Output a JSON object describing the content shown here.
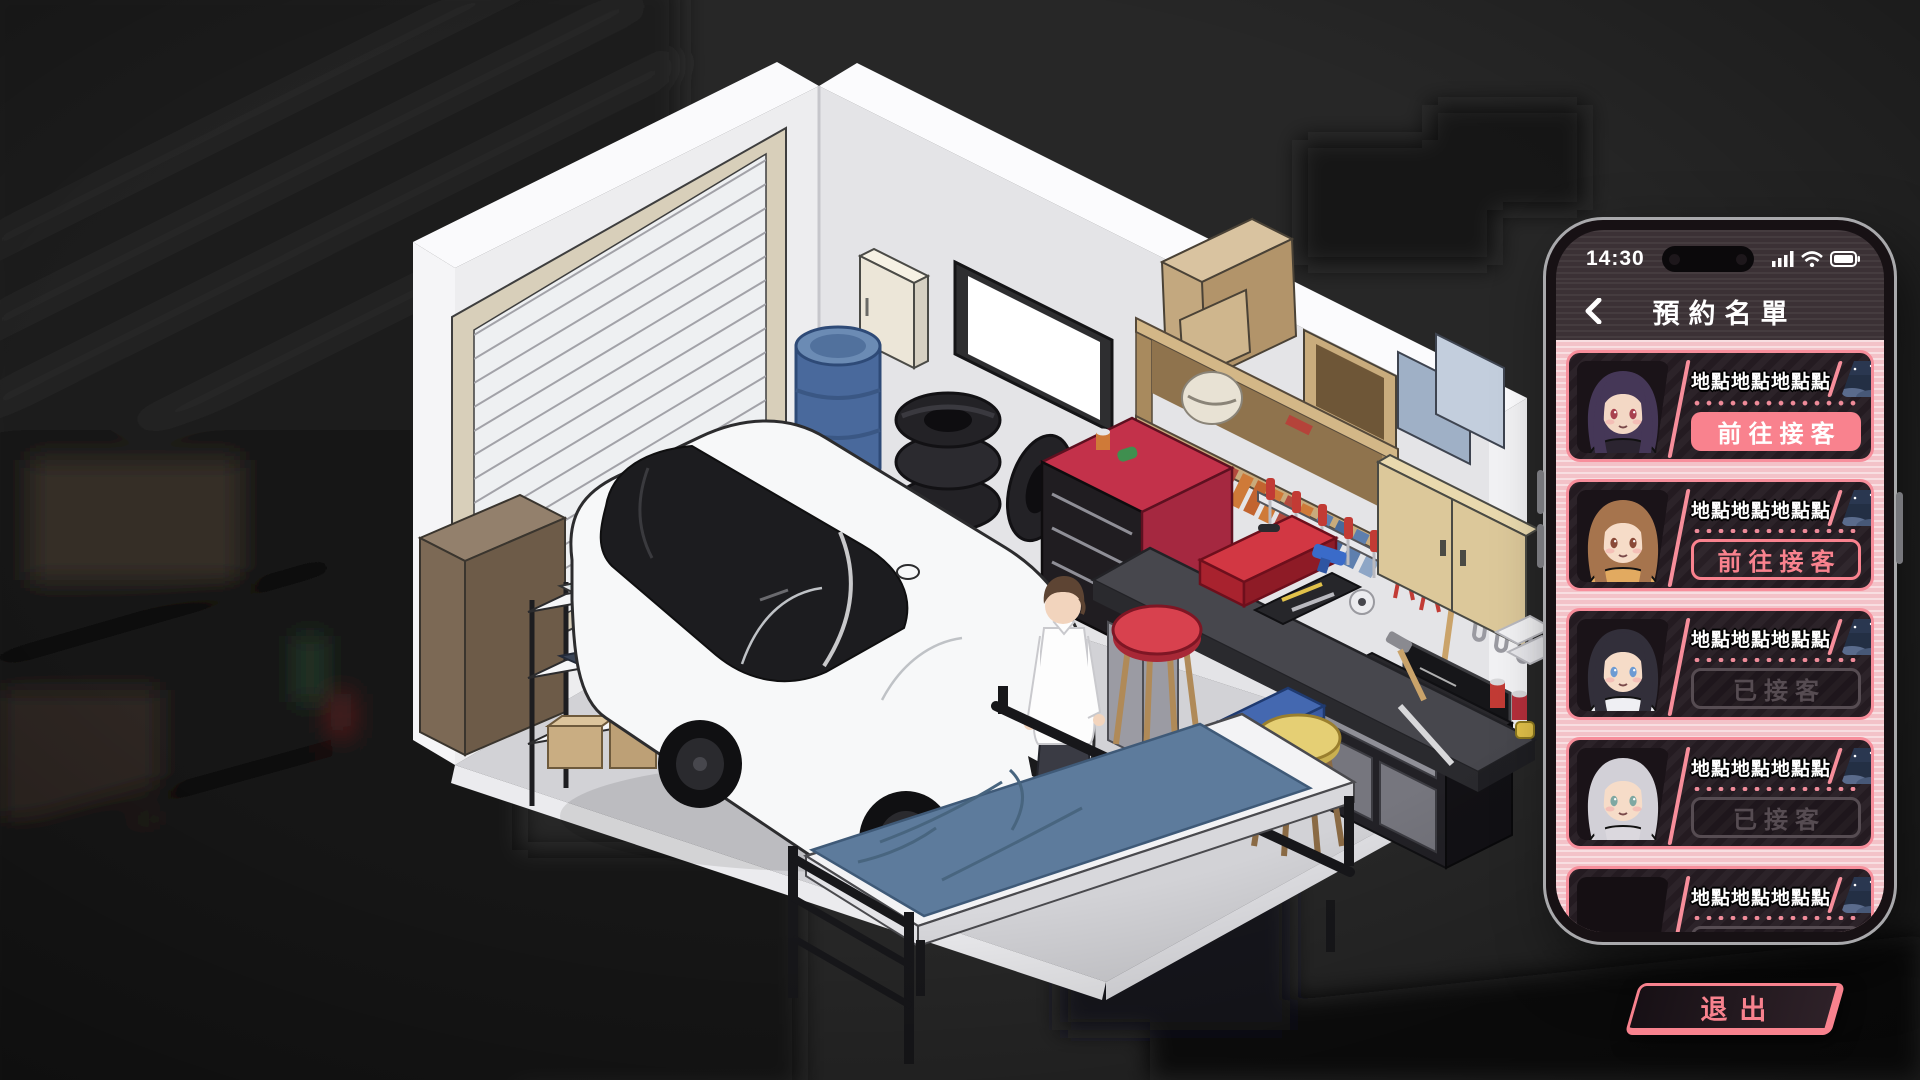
{
  "phone": {
    "status": {
      "time": "14:30"
    },
    "nav": {
      "title": "預約名單"
    },
    "cards": [
      {
        "location": "地點地點地點點",
        "action": "前往接客",
        "state": "primary",
        "time_of_day": "night",
        "avatar": {
          "present": true,
          "hair": "#453757",
          "eyes": "#a8424f",
          "cloth": "#2b2430",
          "skin": "#f3d8c5"
        }
      },
      {
        "location": "地點地點地點點",
        "action": "前往接客",
        "state": "outline",
        "time_of_day": "night",
        "avatar": {
          "present": true,
          "hair": "#a6744d",
          "eyes": "#8a4a38",
          "cloth": "#e2aa60",
          "skin": "#f6dcc8"
        }
      },
      {
        "location": "地點地點地點點",
        "action": "已接客",
        "state": "disabled",
        "time_of_day": "night",
        "avatar": {
          "present": true,
          "hair": "#322f3a",
          "eyes": "#6d9bd3",
          "cloth": "#efeff3",
          "skin": "#f6dcc8"
        }
      },
      {
        "location": "地點地點地點點",
        "action": "已接客",
        "state": "disabled",
        "time_of_day": "night",
        "avatar": {
          "present": true,
          "hair": "#d2d0d7",
          "eyes": "#7fa8a2",
          "cloth": "#dbd8de",
          "skin": "#f6dcc8"
        }
      },
      {
        "location": "地點地點地點點",
        "action": "已接客",
        "state": "disabled",
        "time_of_day": "night",
        "avatar": {
          "present": false
        }
      }
    ],
    "exit_label": "退出",
    "colors": {
      "accent_pink": "#f9828e",
      "list_bg": "#f3c2c8",
      "card_bg": "#241b21",
      "header_bg": "#3b3135",
      "disabled": "#564c52",
      "badge_night_bg": "#232f44"
    }
  },
  "scene": {
    "colors": {
      "background": "#272727",
      "floor": "#d2d2d6",
      "wall_left": "#ededef",
      "wall_right": "#e4e4e7",
      "car_body": "#f7f8f9",
      "car_glass": "#1c1c1f",
      "blanket": "#5d7b9c",
      "barrel": "#49699c",
      "tool_cabinet_red": "#c3314a",
      "bench_top": "#47474d"
    }
  }
}
